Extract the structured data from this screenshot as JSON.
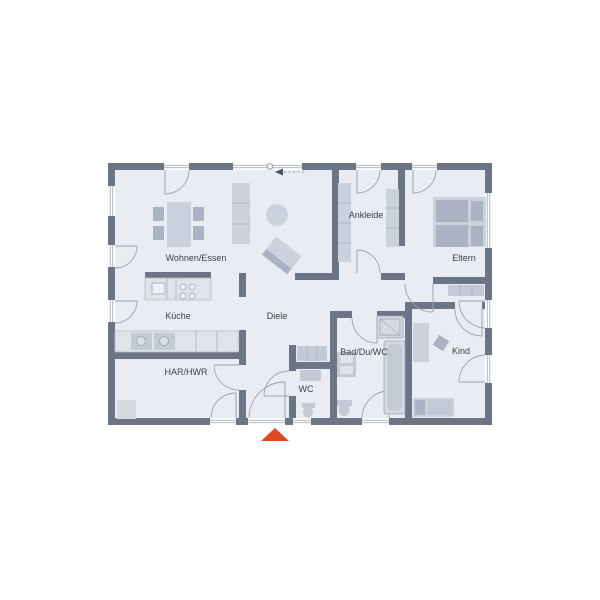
{
  "plan": {
    "type": "floor-plan",
    "rooms": [
      {
        "id": "wohnen",
        "label": "Wohnen/Essen"
      },
      {
        "id": "ankleide",
        "label": "Ankleide"
      },
      {
        "id": "eltern",
        "label": "Eltern"
      },
      {
        "id": "kueche",
        "label": "Küche"
      },
      {
        "id": "diele",
        "label": "Diele"
      },
      {
        "id": "bad",
        "label": "Bad/Du/WC"
      },
      {
        "id": "kind",
        "label": "Kind"
      },
      {
        "id": "har",
        "label": "HAR/HWR"
      },
      {
        "id": "wc",
        "label": "WC"
      }
    ]
  },
  "colors": {
    "wall": "#6b7585",
    "floor": "#e9edf3",
    "furniture_light": "#ccd2dd",
    "furniture_mid": "#c3cad6",
    "furniture_dark": "#aab3c3",
    "label": "#3b3f49",
    "entrance_arrow": "#dd4a1b",
    "window_line": "#aab2bf"
  },
  "markers": {
    "entrance_arrow": "up-triangle",
    "window_pivot_symbol": "circle",
    "orientation_arrow": "left-arrow-dashed"
  }
}
